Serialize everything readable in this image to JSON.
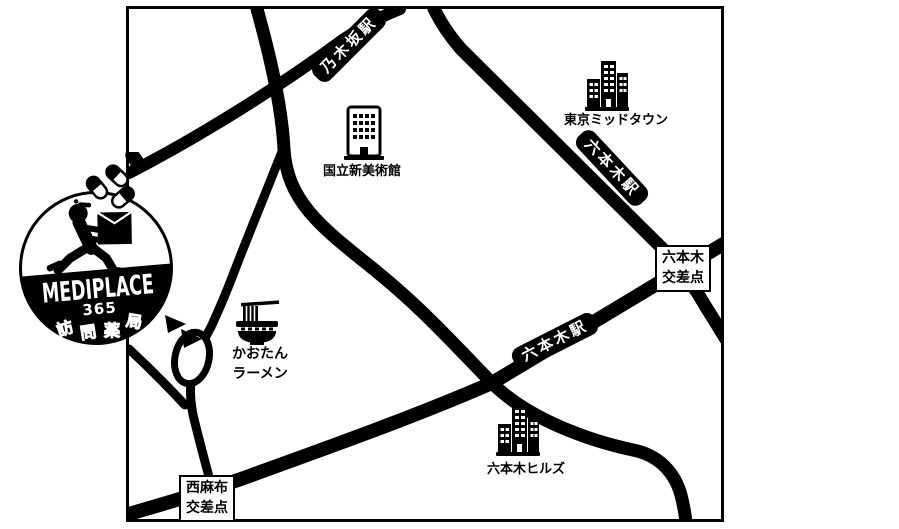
{
  "logo": {
    "brand": "MEDIPLACE",
    "number": "365",
    "subtitle": "訪問薬局",
    "sub_chars": [
      "訪",
      "問",
      "薬",
      "局"
    ]
  },
  "map": {
    "colors": {
      "road": "#000000",
      "background": "#ffffff",
      "station_label_bg": "#000000",
      "station_label_text": "#ffffff"
    },
    "stations": [
      {
        "id": "nogizaka",
        "label": "乃木坂駅"
      },
      {
        "id": "roppongi-gaien",
        "label": "六本木駅"
      },
      {
        "id": "roppongi-dori",
        "label": "六本木駅"
      }
    ],
    "crossings": [
      {
        "id": "roppongi-crossing",
        "line1": "六本木",
        "line2": "交差点"
      },
      {
        "id": "nishiazabu-crossing",
        "line1": "西麻布",
        "line2": "交差点"
      }
    ],
    "places": [
      {
        "id": "national-art-center",
        "label": "国立新美術館"
      },
      {
        "id": "tokyo-midtown",
        "label": "東京ミッドタウン"
      },
      {
        "id": "roppongi-hills",
        "label": "六本木ヒルズ"
      }
    ],
    "ramen": {
      "line1": "かおたん",
      "line2": "ラーメン"
    }
  }
}
